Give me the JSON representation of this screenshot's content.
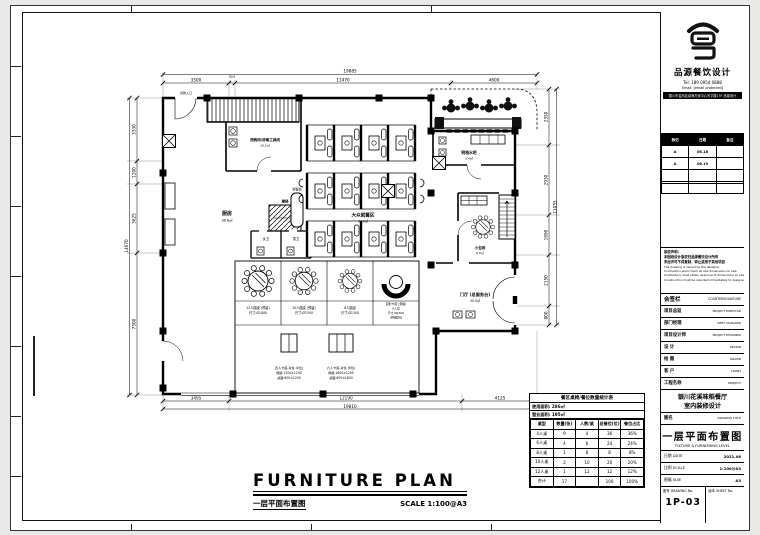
{
  "company": {
    "name": "品源餐饮设计",
    "tel": "Tel: 189 0954 0888",
    "email": "Email: [email protected]",
    "address": "银川市金凤区阅海万家中心写字楼15F 品源设计"
  },
  "revision": {
    "headers": [
      "标记",
      "日期",
      "备注"
    ],
    "rows": [
      [
        "A",
        "06.18",
        ""
      ],
      [
        "A",
        "06.19",
        ""
      ],
      [
        "",
        "",
        ""
      ],
      [
        "",
        "",
        ""
      ]
    ]
  },
  "notes": {
    "cn": [
      "版权声明:",
      "本图纸设计版权归品源餐饮设计所有",
      "未经许可不得复制、转让或用于其他项目"
    ],
    "en": [
      "The drawing is owned by the designer.",
      "Contractors shall check all site dimensions on site.",
      "Contractors must obtain approval of dimensions on site.",
      "Construction must be reported immediately to designer."
    ]
  },
  "countersign": {
    "cn": "会签栏",
    "en": "COUNTERSIGNATURE",
    "rows": [
      {
        "cn": "项目总监",
        "en": "PROJECT DIRECTOR"
      },
      {
        "cn": "部门经理",
        "en": "DEPT. MANAGER"
      },
      {
        "cn": "项目设计师",
        "en": "PROJECT DESIGNER"
      },
      {
        "cn": "设 计",
        "en": "DESIGN"
      },
      {
        "cn": "绘 图",
        "en": "DRAWN"
      },
      {
        "cn": "客 户",
        "en": "CLIENT"
      }
    ]
  },
  "project": {
    "label_cn": "工程名称",
    "label_en": "PROJECT",
    "line1": "银川花溪味稻餐厅",
    "line2": "室内装修设计"
  },
  "drawing": {
    "label_cn": "图名",
    "label_en": "DRAWING TITLE",
    "title_cn": "一层平面布置图",
    "title_en": "FIXTURE & FURNISHING LEVEL"
  },
  "meta": {
    "rows": [
      {
        "label": "日期 DATE",
        "value": "2021.06"
      },
      {
        "label": "比例 SCALE",
        "value": "1:100@A3"
      },
      {
        "label": "图幅 SIZE",
        "value": "A3"
      }
    ],
    "no_label": "图号 DRAWING No.",
    "no_value": "1P-03",
    "sheet_label": "版本 SHEET No."
  },
  "footer": {
    "title": "FURNITURE PLAN",
    "subtitle_cn": "一层平面布置图",
    "scale": "SCALE  1:100@A3"
  },
  "plan": {
    "dims": {
      "top_total": "19885",
      "top": [
        "3500",
        "315",
        "11470",
        "4600"
      ],
      "left_total": "14670",
      "left": [
        "3330",
        "1200",
        "3625",
        "7500"
      ],
      "right_total": "11055",
      "right": [
        "2350",
        "2930",
        "1690",
        "2150",
        "800"
      ],
      "bottom_total": "19810",
      "bottom": [
        "3495",
        "12190",
        "4125"
      ]
    },
    "rooms": {
      "kitchen": {
        "name": "厨房",
        "area": "38.6㎡"
      },
      "dishwash": {
        "name": "洗碗间/消毒工具间",
        "area": "16.5㎡"
      },
      "stair": {
        "name": "楼梯"
      },
      "cashier": {
        "name": "收银台"
      },
      "wc_w": {
        "name": "女卫"
      },
      "wc_m": {
        "name": "男卫"
      },
      "dining": {
        "name": "大众就餐区",
        "area": "94.0㎡"
      },
      "bar": {
        "name": "明档水吧",
        "area": "9.4㎡"
      },
      "private": {
        "name": "小包间",
        "area": "6.6㎡"
      },
      "hall": {
        "name": "门厅 (总服务台)",
        "area": "30.0㎡"
      },
      "goods": {
        "name": "货物入口"
      }
    },
    "legend": {
      "round": [
        {
          "l1": "12人圆桌 (预留)",
          "l2": "尺寸:Ø1800"
        },
        {
          "l1": "10人圆桌 (预留)",
          "l2": "尺寸:Ø1500"
        },
        {
          "l1": "8人圆桌",
          "l2": "尺寸:Ø1300"
        },
        {
          "l1": "弧形卡座 (预留)",
          "l2": "6人位",
          "l3": "尺寸:Ø1600",
          "l4": "定制软包"
        }
      ],
      "rect": [
        {
          "l1": "四人卡座-对坐 (4位)",
          "l2": "规格:1200×1200",
          "l3": "桌面:600×1200"
        },
        {
          "l1": "六人卡座-对坐 (6位)",
          "l2": "规格:1800×1200",
          "l3": "桌面:600×1800"
        }
      ]
    }
  },
  "stats": {
    "title": "餐区桌椅/餐位数量统计表",
    "area1": "使用面积: 286㎡",
    "area2": "营业面积: 195㎡",
    "headers": [
      "桌型",
      "数量(张)",
      "人数/桌",
      "总餐位(位)",
      "餐位占比"
    ],
    "rows": [
      [
        "4人桌",
        "9",
        "4",
        "36",
        "36%"
      ],
      [
        "6人桌",
        "4",
        "6",
        "24",
        "24%"
      ],
      [
        "8人桌",
        "1",
        "8",
        "8",
        "8%"
      ],
      [
        "10人桌",
        "2",
        "10",
        "20",
        "20%"
      ],
      [
        "12人桌",
        "1",
        "12",
        "12",
        "12%"
      ],
      [
        "合计",
        "17",
        "",
        "100",
        "100%"
      ]
    ]
  }
}
